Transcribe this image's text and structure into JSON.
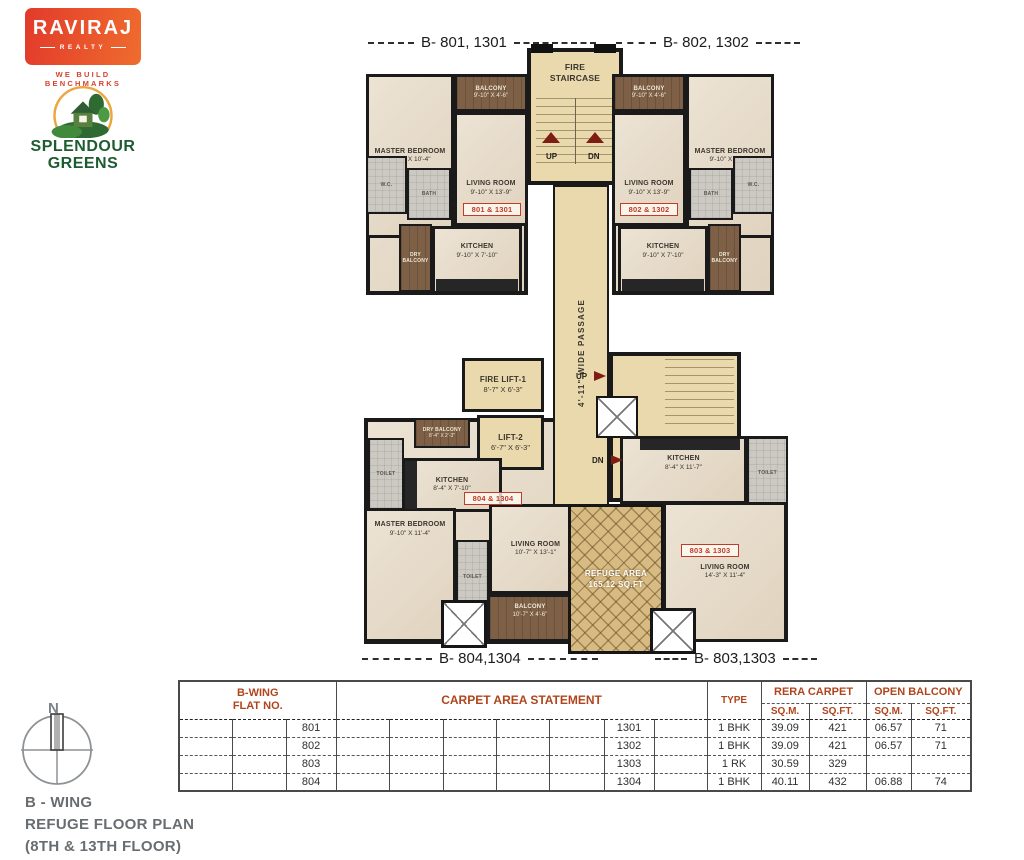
{
  "branding": {
    "logo_title": "RAVIRAJ",
    "logo_subtitle": "REALTY",
    "logo_tagline": "WE BUILD BENCHMARKS",
    "project_line1": "SPLENDOUR",
    "project_line2": "GREENS"
  },
  "callouts": {
    "top_left": "B- 801, 1301",
    "top_right": "B- 802, 1302",
    "bottom_left": "B- 804,1304",
    "bottom_right": "B- 803,1303"
  },
  "core": {
    "fire_staircase": "FIRE STAIRCASE",
    "up": "UP",
    "dn": "DN",
    "fire_lift1_name": "FIRE LIFT-1",
    "fire_lift1_dims": "8'-7\" X 6'-3\"",
    "lift2_name": "LIFT-2",
    "lift2_dims": "6'-7\" X 6'-3\"",
    "passage": "4'-11\" WIDE PASSAGE",
    "refuge_name": "REFUGE AREA",
    "refuge_area": "165.12 SQ.FT"
  },
  "flats": {
    "f801": {
      "tag": "801 & 1301",
      "master_bedroom": {
        "name": "MASTER BEDROOM",
        "dims": "9'-10\" X 10'-4\""
      },
      "balcony": {
        "name": "BALCONY",
        "dims": "9'-10\" X 4'-6\""
      },
      "living_room": {
        "name": "LIVING ROOM",
        "dims": "9'-10\" X 13'-9\""
      },
      "kitchen": {
        "name": "KITCHEN",
        "dims": "9'-10\" X 7'-10\""
      },
      "dry_balcony": {
        "name": "DRY BALCONY"
      },
      "bath": {
        "name": "BATH"
      },
      "wc": {
        "name": "W.C."
      }
    },
    "f802": {
      "tag": "802 & 1302",
      "master_bedroom": {
        "name": "MASTER BEDROOM",
        "dims": "9'-10\" X 10'-4\""
      },
      "balcony": {
        "name": "BALCONY",
        "dims": "9'-10\" X 4'-6\""
      },
      "living_room": {
        "name": "LIVING ROOM",
        "dims": "9'-10\" X 13'-9\""
      },
      "kitchen": {
        "name": "KITCHEN",
        "dims": "9'-10\" X 7'-10\""
      },
      "dry_balcony": {
        "name": "DRY BALCONY"
      },
      "bath": {
        "name": "BATH"
      },
      "wc": {
        "name": "W.C."
      }
    },
    "f803": {
      "tag": "803 & 1303",
      "kitchen": {
        "name": "KITCHEN",
        "dims": "8'-4\" X 11'-7\""
      },
      "living_room": {
        "name": "LIVING ROOM",
        "dims": "14'-3\" X 11'-4\""
      },
      "toilet": {
        "name": "TOILET"
      }
    },
    "f804": {
      "tag": "804 & 1304",
      "dry_balcony": {
        "name": "DRY BALCONY",
        "dims": "8'-4\" X 2'-3\""
      },
      "kitchen": {
        "name": "KITCHEN",
        "dims": "8'-4\" X 7'-10\""
      },
      "master_bedroom": {
        "name": "MASTER BEDROOM",
        "dims": "9'-10\" X 11'-4\""
      },
      "living_room": {
        "name": "LIVING ROOM",
        "dims": "10'-7\" X 13'-1\""
      },
      "balcony": {
        "name": "BALCONY",
        "dims": "10'-7\" X 4'-6\""
      },
      "toilet": {
        "name": "TOILET"
      },
      "toilet2": {
        "name": "TOILET"
      }
    }
  },
  "table": {
    "flat_no_line1": "B-WING",
    "flat_no_line2": "FLAT NO.",
    "carpet_header": "CARPET AREA STATEMENT",
    "type_header": "TYPE",
    "rera_header": "RERA CARPET",
    "open_header": "OPEN BALCONY",
    "sqm": "SQ.M.",
    "sqft": "SQ.FT.",
    "rows": [
      {
        "flat": "801",
        "flat2": "1301",
        "type": "1 BHK",
        "rera_sqm": "39.09",
        "rera_sqft": "421",
        "open_sqm": "06.57",
        "open_sqft": "71"
      },
      {
        "flat": "802",
        "flat2": "1302",
        "type": "1 BHK",
        "rera_sqm": "39.09",
        "rera_sqft": "421",
        "open_sqm": "06.57",
        "open_sqft": "71"
      },
      {
        "flat": "803",
        "flat2": "1303",
        "type": "1 RK",
        "rera_sqm": "30.59",
        "rera_sqft": "329",
        "open_sqm": "",
        "open_sqft": ""
      },
      {
        "flat": "804",
        "flat2": "1304",
        "type": "1 BHK",
        "rera_sqm": "40.11",
        "rera_sqft": "432",
        "open_sqm": "06.88",
        "open_sqft": "74"
      }
    ]
  },
  "footer": {
    "compass_n": "N",
    "title_line1": "B - WING",
    "title_line2": "REFUGE FLOOR PLAN",
    "title_line3": "(8TH & 13TH FLOOR)"
  },
  "colors": {
    "accent_red": "#c23b2a",
    "table_header_rust": "#b0451d",
    "core_tan": "#e9d9ac",
    "floor_beige": "#e6dccc",
    "balcony_brown": "#7d6046",
    "toilet_gray": "#ccc9c2",
    "refuge_tan": "#d7bb83",
    "wall_black": "#1a1a1a",
    "logo_red": "#e23a2b",
    "logo_orange": "#ef6c2e",
    "project_green": "#1d5c31"
  }
}
